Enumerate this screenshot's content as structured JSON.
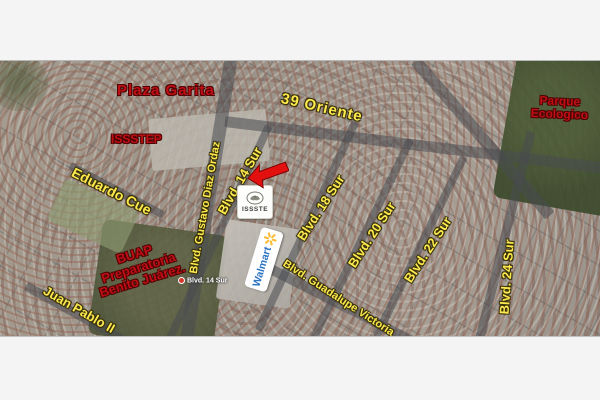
{
  "map": {
    "annotations": {
      "plaza_garita": "Plaza Garita",
      "issstep": "ISSSTEP",
      "parque_ecologico": {
        "line1": "Parque",
        "line2": "Ecologico"
      },
      "buap": {
        "line1": "BUAP",
        "line2": "Preparatoria",
        "line3": "Benito Juárez."
      }
    },
    "street_labels": {
      "oriente_39": "39 Oriente",
      "eduardo_cue": "Eduardo Cue",
      "gustavo_diaz_ordaz": "Blvd. Gustavo Diaz Ordaz",
      "blvd_14_sur": "Blvd. 14 Sur",
      "blvd_18_sur": "Blvd. 18 Sur",
      "blvd_20_sur": "Blvd. 20 Sur",
      "blvd_22_sur": "Blvd. 22 Sur",
      "blvd_24_sur": "Blvd. 24 Sur",
      "guadalupe_victoria": "Blvd. Guadalupe Victoria",
      "juan_pablo_ii": "Juan Pablo II",
      "blvd_14_sur_small": "Blvd. 14 Sur"
    },
    "pois": {
      "issste_logo_text": "ISSSTE",
      "walmart_logo_text": "Walmart"
    },
    "colors": {
      "street_label_yellow": "#fde84e",
      "annotation_red": "#bf0f14",
      "page_background": "#f4f4f4",
      "walmart_blue": "#2a72c2",
      "walmart_spark_yellow": "#fdbb30",
      "marker_red": "#e31010",
      "park_green": "#44522f"
    }
  }
}
